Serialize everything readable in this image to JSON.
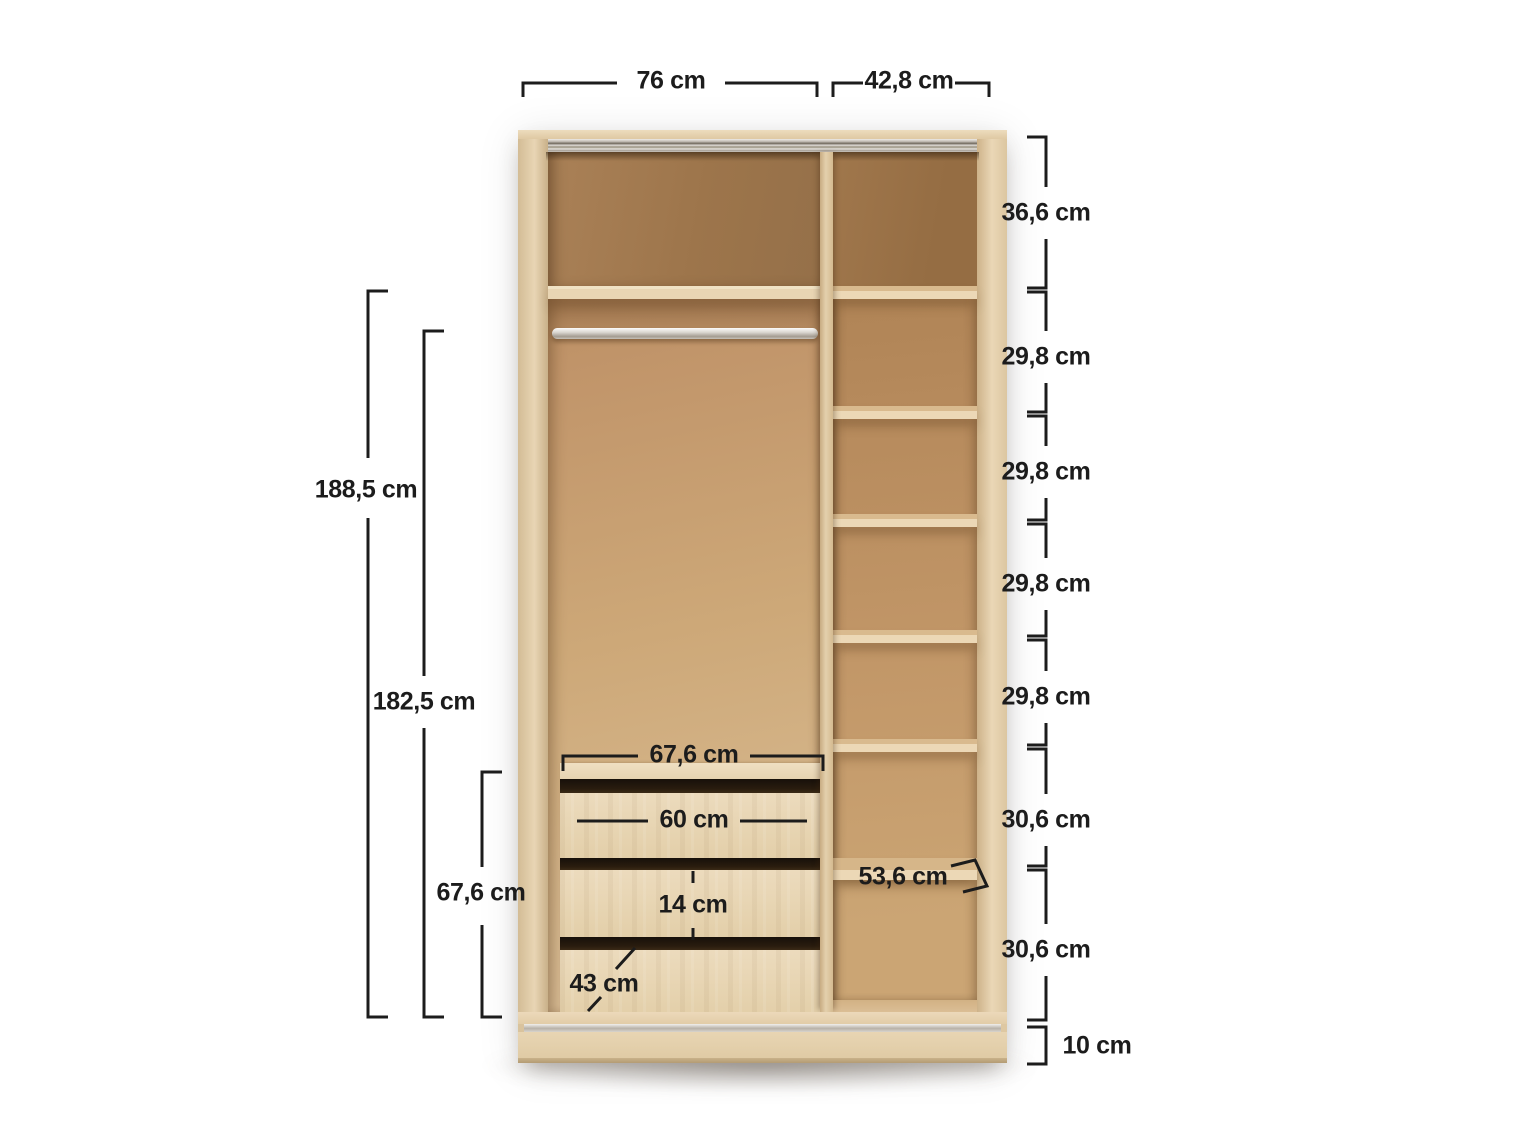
{
  "diagram": {
    "subject": "wardrobe-interior-dimension-diagram",
    "unit_suffix": "cm"
  },
  "dimensions": {
    "top_widths": {
      "left_section": "76 cm",
      "right_section": "42,8 cm"
    },
    "right_column_heights": [
      "36,6 cm",
      "29,8 cm",
      "29,8 cm",
      "29,8 cm",
      "29,8 cm",
      "30,6 cm",
      "30,6 cm"
    ],
    "plinth_height": "10 cm",
    "left_heights": {
      "interior_total": "188,5 cm",
      "hanging_space": "182,5 cm",
      "drawer_unit": "67,6 cm"
    },
    "drawer_unit": {
      "width": "67,6 cm",
      "inner_width": "60 cm",
      "inner_height": "14 cm",
      "depth": "43 cm"
    },
    "shelf_depth": "53,6 cm"
  },
  "colors": {
    "background": "#ffffff",
    "dim_line": "#1c1c1c",
    "frame_oak": "#e3cfab",
    "back_oak": "#cdab80",
    "back_oak_dark": "#9e7750",
    "shelf_edge": "#ead6b4",
    "drawer_face": "#e8d6b6",
    "gap_dark": "#21160b",
    "track_silver": "#c9c4bc"
  }
}
